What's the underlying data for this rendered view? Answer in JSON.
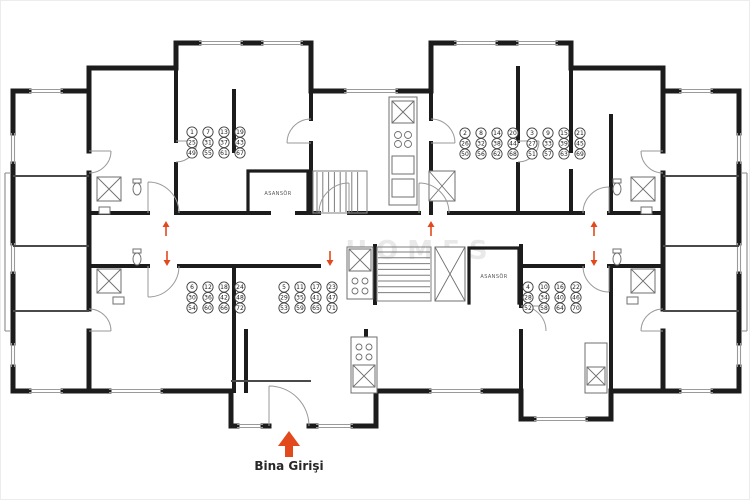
{
  "floorplan": {
    "watermark": "HOMES",
    "entrance": {
      "label": "Bina Girişi"
    },
    "elevators": [
      {
        "label": "ASANSÖR"
      },
      {
        "label": "ASANSÖR"
      }
    ],
    "units": [
      {
        "unit": "1",
        "x": 191,
        "y": 131,
        "rows": [
          [
            "1",
            "7",
            "13",
            "19"
          ],
          [
            "25",
            "31",
            "37",
            "43"
          ],
          [
            "49",
            "55",
            "61",
            "67"
          ]
        ]
      },
      {
        "unit": "2",
        "x": 464,
        "y": 132,
        "rows": [
          [
            "2",
            "8",
            "14",
            "20"
          ],
          [
            "26",
            "32",
            "38",
            "44"
          ],
          [
            "50",
            "56",
            "62",
            "68"
          ]
        ]
      },
      {
        "unit": "3",
        "x": 531,
        "y": 132,
        "rows": [
          [
            "3",
            "9",
            "15",
            "21"
          ],
          [
            "27",
            "33",
            "39",
            "45"
          ],
          [
            "51",
            "57",
            "63",
            "69"
          ]
        ]
      },
      {
        "unit": "6",
        "x": 191,
        "y": 286,
        "rows": [
          [
            "6",
            "12",
            "18",
            "24"
          ],
          [
            "30",
            "36",
            "42",
            "48"
          ],
          [
            "54",
            "60",
            "66",
            "72"
          ]
        ]
      },
      {
        "unit": "5",
        "x": 283,
        "y": 286,
        "rows": [
          [
            "5",
            "11",
            "17",
            "23"
          ],
          [
            "29",
            "35",
            "41",
            "47"
          ],
          [
            "53",
            "59",
            "65",
            "71"
          ]
        ]
      },
      {
        "unit": "4",
        "x": 527,
        "y": 286,
        "rows": [
          [
            "4",
            "10",
            "16",
            "22"
          ],
          [
            "28",
            "34",
            "40",
            "46"
          ],
          [
            "52",
            "58",
            "64",
            "70"
          ]
        ]
      }
    ],
    "direction_arrows": [
      {
        "x": 165,
        "y": 221,
        "dir": "up"
      },
      {
        "x": 166,
        "y": 250,
        "dir": "down"
      },
      {
        "x": 329,
        "y": 250,
        "dir": "down"
      },
      {
        "x": 430,
        "y": 221,
        "dir": "up"
      },
      {
        "x": 593,
        "y": 221,
        "dir": "up"
      },
      {
        "x": 593,
        "y": 250,
        "dir": "down"
      }
    ],
    "colors": {
      "wall": "#1c1c1c",
      "thin": "#8a8a8a",
      "accent": "#e2491d",
      "watermark_gray": "#9d9d9d"
    }
  }
}
